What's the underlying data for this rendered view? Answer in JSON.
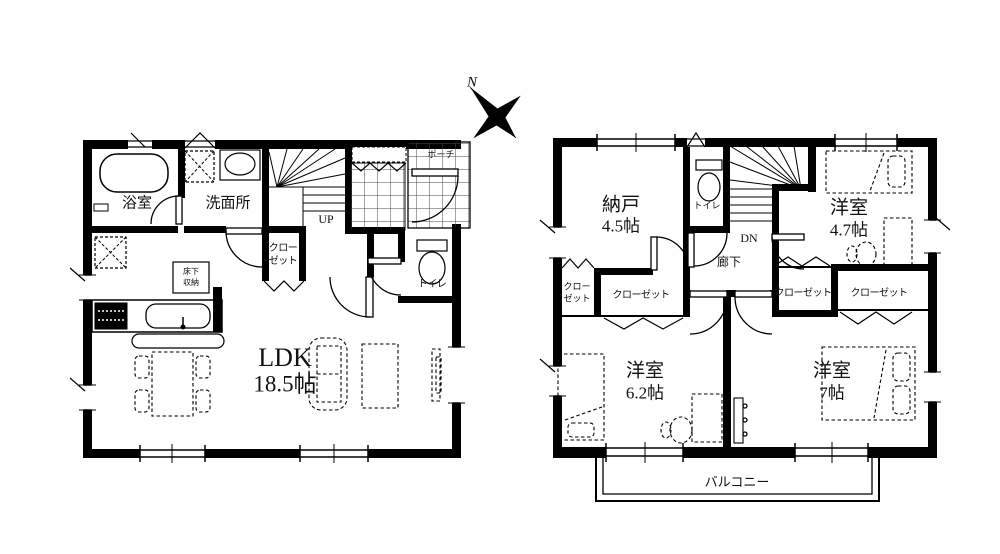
{
  "compass": {
    "north": "N"
  },
  "floor1": {
    "bath": "浴室",
    "washroom": "洗面所",
    "stairs_up": "UP",
    "closet_line1": "クロー",
    "closet_line2": "ゼット",
    "toilet": "トイレ",
    "underfloor_line1": "床下",
    "underfloor_line2": "収納",
    "ldk_name": "LDK",
    "ldk_size": "18.5帖",
    "porch": "ポーチ"
  },
  "floor2": {
    "storage_name": "納戸",
    "storage_size": "4.5帖",
    "toilet": "トイレ",
    "stairs_down": "DN",
    "hallway": "廊下",
    "closet_small_line1": "クロー",
    "closet_small_line2": "ゼット",
    "closet_center": "クローゼット",
    "closet_ne": "クローゼット",
    "closet_se": "クローゼット",
    "room_ne_name": "洋室",
    "room_ne_size": "4.7帖",
    "room_sw_name": "洋室",
    "room_sw_size": "6.2帖",
    "room_se_name": "洋室",
    "room_se_size": "7帖",
    "balcony": "バルコニー"
  },
  "ink": "#000000",
  "background": "#ffffff"
}
